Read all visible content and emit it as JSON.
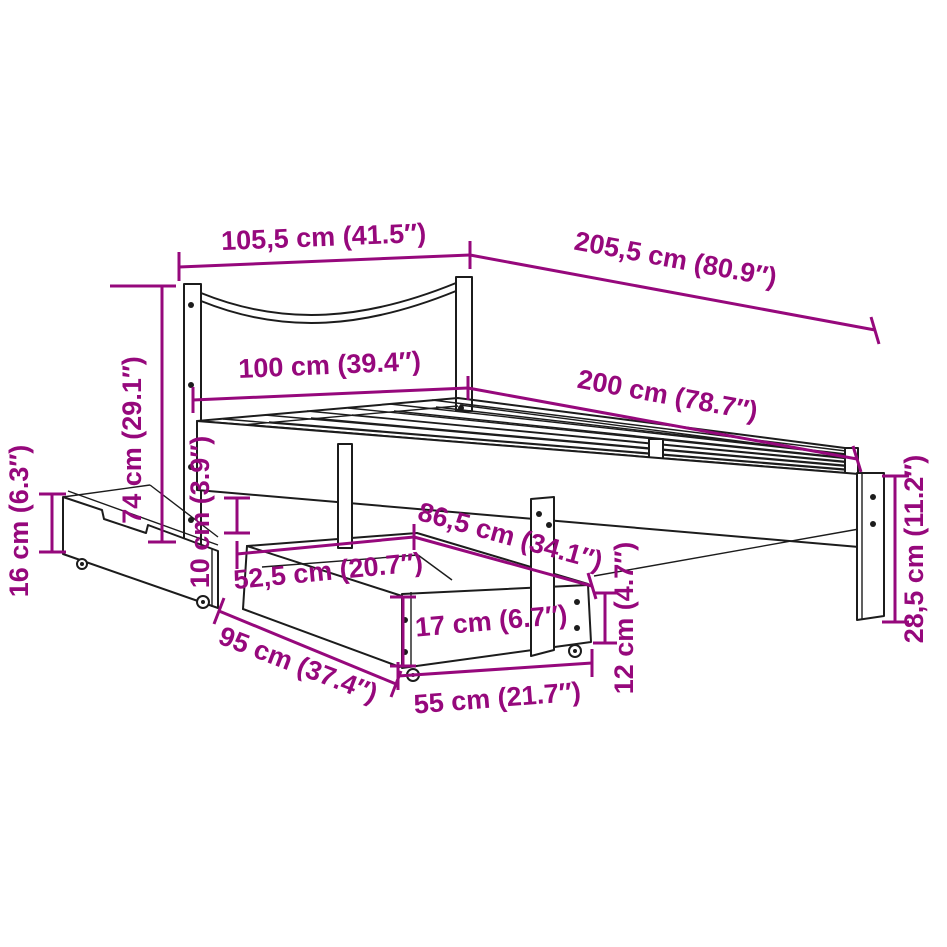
{
  "diagram": {
    "type": "product-dimension-line-drawing",
    "subject": "bed frame with slatted base, headboard and two under-bed storage drawers on casters",
    "colors": {
      "dimension_accent": "#96087c",
      "line_art": "#1c1c1c",
      "background": "#ffffff"
    },
    "dimensions": [
      {
        "id": "headboard-top-width",
        "label": "105,5 cm (41.5″)",
        "cm": 105.5,
        "inches": 41.5
      },
      {
        "id": "overall-length",
        "label": "205,5 cm (80.9″)",
        "cm": 205.5,
        "inches": 80.9
      },
      {
        "id": "bed-width",
        "label": "100 cm (39.4″)",
        "cm": 100,
        "inches": 39.4
      },
      {
        "id": "bed-length",
        "label": "200 cm (78.7″)",
        "cm": 200,
        "inches": 78.7
      },
      {
        "id": "headboard-height",
        "label": "74 cm (29.1″)",
        "cm": 74,
        "inches": 29.1
      },
      {
        "id": "side-drawer-height",
        "label": "16 cm (6.3″)",
        "cm": 16,
        "inches": 6.3
      },
      {
        "id": "under-bed-clearance",
        "label": "10 cm (3.9″)",
        "cm": 10,
        "inches": 3.9
      },
      {
        "id": "drawer-inner-width",
        "label": "52,5 cm (20.7″)",
        "cm": 52.5,
        "inches": 20.7
      },
      {
        "id": "drawer-top-depth",
        "label": "86,5 cm (34.1″)",
        "cm": 86.5,
        "inches": 34.1
      },
      {
        "id": "front-drawer-height",
        "label": "17 cm (6.7″)",
        "cm": 17,
        "inches": 6.7
      },
      {
        "id": "drawer-end-height",
        "label": "12 cm (4.7″)",
        "cm": 12,
        "inches": 4.7
      },
      {
        "id": "drawer-front-width",
        "label": "55 cm (21.7″)",
        "cm": 55,
        "inches": 21.7
      },
      {
        "id": "drawer-length",
        "label": "95 cm (37.4″)",
        "cm": 95,
        "inches": 37.4
      },
      {
        "id": "foot-leg-height",
        "label": "28,5 cm (11.2″)",
        "cm": 28.5,
        "inches": 11.2
      }
    ]
  }
}
